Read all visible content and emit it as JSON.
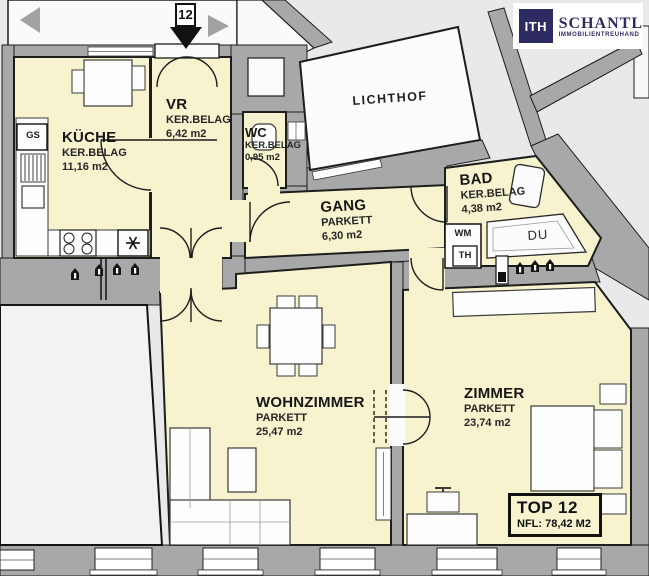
{
  "logo": {
    "monogram": "ITH",
    "name": "SCHANTL",
    "tagline": "IMMOBILIENTREUHAND"
  },
  "unit_marker": "12",
  "rooms": {
    "kueche": {
      "name": "KÜCHE",
      "floor": "KER.BELAG",
      "area": "11,16 m2"
    },
    "vr": {
      "name": "VR",
      "floor": "KER.BELAG",
      "area": "6,42 m2"
    },
    "wc": {
      "name": "WC",
      "floor": "KER.BELAG",
      "area": "0,95 m2"
    },
    "lichthof": {
      "name": "LICHTHOF"
    },
    "gang": {
      "name": "GANG",
      "floor": "PARKETT",
      "area": "6,30 m2"
    },
    "bad": {
      "name": "BAD",
      "floor": "KER.BELAG",
      "area": "4,38 m2"
    },
    "wohnzimmer": {
      "name": "WOHNZIMMER",
      "floor": "PARKETT",
      "area": "25,47 m2"
    },
    "zimmer": {
      "name": "ZIMMER",
      "floor": "PARKETT",
      "area": "23,74 m2"
    }
  },
  "fixtures": {
    "dishwasher": "GS",
    "shower": "DU",
    "washer": "WM",
    "dryer": "TH"
  },
  "summary": {
    "unit": "TOP 12",
    "net_area": "NFL: 78,42 M2"
  },
  "colors": {
    "room": "#f7f3cf",
    "wall": "#a8a8a8",
    "outline": "#1d1d1d",
    "background": "#e9e9e9",
    "neighbor": "#f2f2f2",
    "fixture_white": "#fcfcfc",
    "logo_navy": "#2e2b63",
    "arrow_gray": "#a2a2a2",
    "arrow_black": "#111111"
  }
}
